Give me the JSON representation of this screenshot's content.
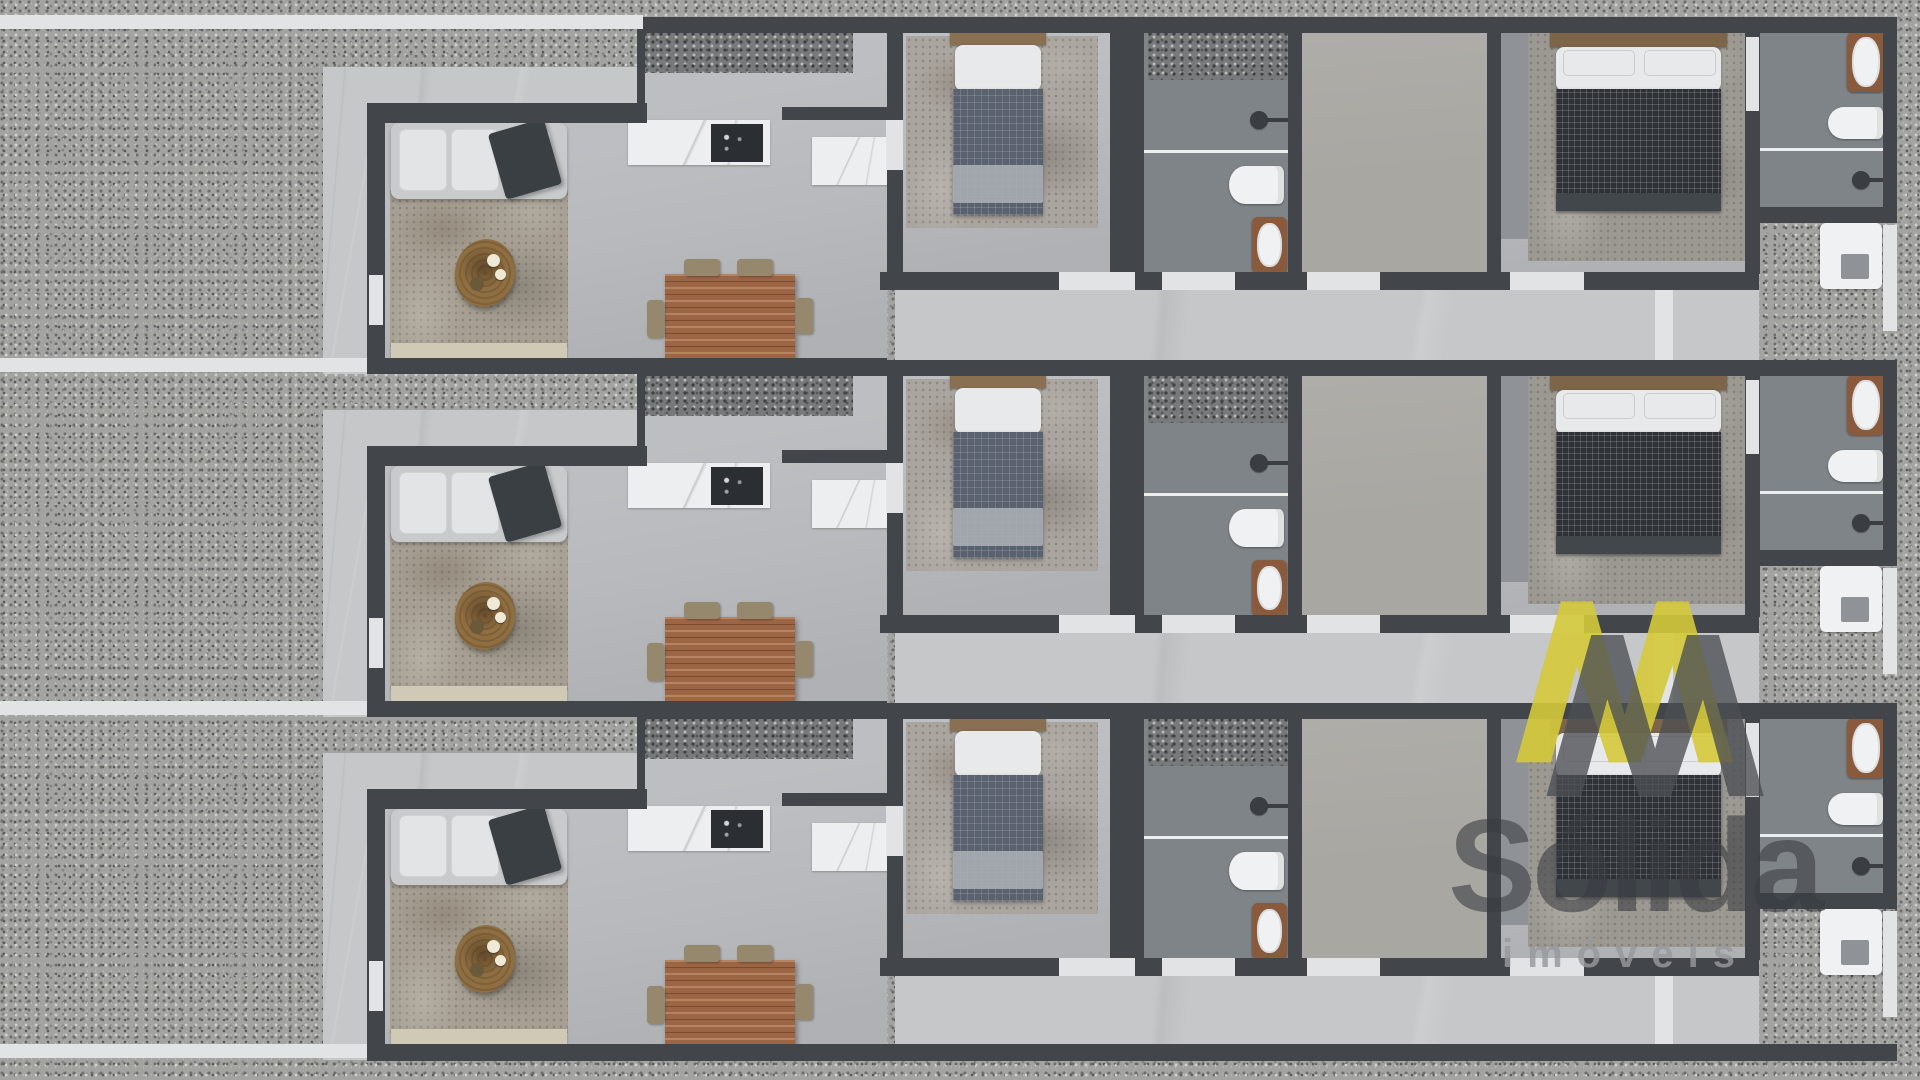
{
  "canvas": {
    "width": 1920,
    "height": 1080
  },
  "watermark": {
    "brand": "Sólida",
    "subtitle": "imóveis",
    "logo_icon": "double-mountain-M-monogram",
    "logo_yellow": "#d5c93a",
    "logo_gray": "#4b4e53",
    "brand_text_color": "rgba(56,59,64,0.58)",
    "subtitle_text_color": "rgba(150,152,156,0.82)"
  },
  "palette": {
    "wall": "#42464b",
    "floor": "#b8babd",
    "walkway": "#c5c7c8",
    "path": "#e2e3e4",
    "gravel": "#a3a3a1",
    "pebble": "#77797a",
    "bathFloor": "#7f8488",
    "hallFloor": "#a8a7a2",
    "cabinet": "#8f9397",
    "marble": "#edeeef",
    "cooktop": "#2b2f33",
    "rugBrown": "#a69f92",
    "rugGray": "#aaa59e",
    "rugGray2": "#9c9892",
    "sofa": "#c8cacc",
    "cushion": "#e3e4e5",
    "throw": "#3a3f44",
    "ctable": "#8f6e41",
    "plate": "#efe9d8",
    "plateDark": "#6b5a3a",
    "bench": "#cfc9b6",
    "dwood": "#9c6544",
    "chair": "#95886c",
    "woodHead": "#8a7052",
    "woodHead2": "#7c6549",
    "pillow": "#e8e9ea",
    "denim": "#5a6270",
    "tufted": "#2e3237",
    "blanket": "#a9aeb4",
    "footboard": "#42474c",
    "white": "#f0f1f2",
    "frame": "#8a5a3d",
    "shower": "#3a3e42"
  },
  "units": [
    {
      "id": "house-unit-1",
      "y": 17
    },
    {
      "id": "house-unit-2",
      "y": 360
    },
    {
      "id": "house-unit-3",
      "y": 703
    }
  ],
  "unit_template": [
    {
      "name": "front-path",
      "cls": "path",
      "x": 0,
      "y": -2,
      "w": 367,
      "h": 14
    },
    {
      "name": "front-walkway",
      "cls": "walkway",
      "x": 323,
      "y": 50,
      "w": 320,
      "h": 36
    },
    {
      "name": "side-walkway",
      "cls": "walkway",
      "x": 323,
      "y": 50,
      "w": 44,
      "h": 307
    },
    {
      "name": "back-terrace",
      "cls": "walkway",
      "x": 895,
      "y": 273,
      "w": 864,
      "h": 70
    },
    {
      "name": "terrace-step",
      "cls": "path",
      "x": 1655,
      "y": 273,
      "w": 18,
      "h": 70
    },
    {
      "name": "utility-pad",
      "cls": "pad",
      "x": 1820,
      "y": 206,
      "w": 62,
      "h": 66
    },
    {
      "name": "utility-pad-basin",
      "cls": "pad-inner",
      "x": 1841,
      "y": 237,
      "w": 28,
      "h": 25
    },
    {
      "name": "right-path",
      "cls": "path",
      "x": 1883,
      "y": 208,
      "w": 14,
      "h": 106
    },
    {
      "name": "kitchen-floor",
      "cls": "floor",
      "x": 637,
      "y": 14,
      "w": 250,
      "h": 329
    },
    {
      "name": "kitchen-garden-pebbles",
      "cls": "pebbles",
      "x": 643,
      "y": 15,
      "w": 210,
      "h": 41
    },
    {
      "name": "living-room-floor",
      "cls": "floor",
      "x": 383,
      "y": 103,
      "w": 504,
      "h": 240
    },
    {
      "name": "bedroom1-floor",
      "cls": "floor",
      "x": 901,
      "y": 14,
      "w": 211,
      "h": 243
    },
    {
      "name": "bathroom1-floor",
      "cls": "bath-floor",
      "x": 1142,
      "y": 14,
      "w": 148,
      "h": 243
    },
    {
      "name": "corridor-floor",
      "cls": "hall-floor",
      "x": 1300,
      "y": 14,
      "w": 189,
      "h": 243
    },
    {
      "name": "bedroom2-floor",
      "cls": "floor",
      "x": 1499,
      "y": 14,
      "w": 248,
      "h": 243
    },
    {
      "name": "bedroom2-closet",
      "cls": "cabinet",
      "x": 1499,
      "y": 16,
      "w": 30,
      "h": 206
    },
    {
      "name": "bathroom2-floor",
      "cls": "bath-floor",
      "x": 1758,
      "y": 14,
      "w": 127,
      "h": 178
    },
    {
      "name": "living-rug",
      "cls": "rug-brown",
      "x": 390,
      "y": 173,
      "w": 178,
      "h": 157
    },
    {
      "name": "sofa",
      "cls": "sofa",
      "x": 391,
      "y": 106,
      "w": 176,
      "h": 76
    },
    {
      "name": "sofa-cushion",
      "cls": "cushion",
      "x": 399,
      "y": 112,
      "w": 48,
      "h": 62
    },
    {
      "name": "sofa-cushion",
      "cls": "cushion",
      "x": 451,
      "y": 112,
      "w": 48,
      "h": 62
    },
    {
      "name": "sofa-cushion",
      "cls": "cushion",
      "x": 503,
      "y": 112,
      "w": 48,
      "h": 62
    },
    {
      "name": "sofa-throw-blanket",
      "cls": "throw",
      "x": 496,
      "y": 108,
      "w": 58,
      "h": 68,
      "r": -16
    },
    {
      "name": "coffee-table",
      "cls": "ctable",
      "x": 455,
      "y": 222,
      "w": 60,
      "h": 68,
      "r": 12
    },
    {
      "name": "coffee-table-plate",
      "cls": "plate",
      "x": 487,
      "y": 237,
      "w": 13,
      "h": 13
    },
    {
      "name": "coffee-table-plate",
      "cls": "plate",
      "x": 495,
      "y": 252,
      "w": 11,
      "h": 11
    },
    {
      "name": "coffee-table-bowl",
      "cls": "plate-dark",
      "x": 470,
      "y": 260,
      "w": 14,
      "h": 14
    },
    {
      "name": "window-bench",
      "cls": "bench",
      "x": 391,
      "y": 326,
      "w": 176,
      "h": 15
    },
    {
      "name": "kitchen-counter",
      "cls": "marble",
      "x": 628,
      "y": 103,
      "w": 142,
      "h": 45
    },
    {
      "name": "cooktop",
      "cls": "cooktop",
      "x": 711,
      "y": 107,
      "w": 52,
      "h": 38
    },
    {
      "name": "sink-counter",
      "cls": "marble",
      "x": 812,
      "y": 120,
      "w": 78,
      "h": 48
    },
    {
      "name": "dining-table",
      "cls": "dtable",
      "x": 665,
      "y": 257,
      "w": 130,
      "h": 86
    },
    {
      "name": "dining-chair",
      "cls": "chair",
      "x": 684,
      "y": 242,
      "w": 36,
      "h": 17
    },
    {
      "name": "dining-chair",
      "cls": "chair",
      "x": 737,
      "y": 242,
      "w": 36,
      "h": 17
    },
    {
      "name": "dining-chair",
      "cls": "chair-side",
      "x": 647,
      "y": 283,
      "w": 17,
      "h": 38
    },
    {
      "name": "dining-chair",
      "cls": "chair-side",
      "x": 796,
      "y": 281,
      "w": 17,
      "h": 36
    },
    {
      "name": "bedroom1-rug",
      "cls": "rug-gray",
      "x": 906,
      "y": 19,
      "w": 192,
      "h": 192
    },
    {
      "name": "bed1-headboard",
      "cls": "wood-head",
      "x": 950,
      "y": 14,
      "w": 96,
      "h": 14
    },
    {
      "name": "bed1-pillow",
      "cls": "pillow",
      "x": 955,
      "y": 28,
      "w": 86,
      "h": 46
    },
    {
      "name": "bed1-duvet",
      "cls": "duvet-denim",
      "x": 953,
      "y": 72,
      "w": 90,
      "h": 126
    },
    {
      "name": "bed1-foot-blanket",
      "cls": "blanket",
      "x": 953,
      "y": 148,
      "w": 90,
      "h": 38
    },
    {
      "name": "bathroom1-pebbles",
      "cls": "pebbles",
      "x": 1148,
      "y": 15,
      "w": 140,
      "h": 48
    },
    {
      "name": "shower1-glass",
      "cls": "glass",
      "x": 1144,
      "y": 133,
      "w": 144,
      "h": 3
    },
    {
      "name": "shower1-arm",
      "cls": "shower-arm",
      "x": 1266,
      "y": 101,
      "w": 22,
      "h": 4
    },
    {
      "name": "shower1-head",
      "cls": "shower",
      "x": 1250,
      "y": 94,
      "w": 18,
      "h": 18
    },
    {
      "name": "toilet1",
      "cls": "toilet",
      "x": 1229,
      "y": 149,
      "w": 55,
      "h": 38
    },
    {
      "name": "sink1-frame",
      "cls": "wood-frame",
      "x": 1252,
      "y": 200,
      "w": 35,
      "h": 56
    },
    {
      "name": "sink1-bowl",
      "cls": "bowl",
      "x": 1257,
      "y": 206,
      "w": 25,
      "h": 44
    },
    {
      "name": "bedroom2-rug",
      "cls": "rug-gray2",
      "x": 1528,
      "y": 14,
      "w": 222,
      "h": 230
    },
    {
      "name": "bed2-headboard",
      "cls": "wood-head2",
      "x": 1550,
      "y": 16,
      "w": 177,
      "h": 14
    },
    {
      "name": "bed2-linen",
      "cls": "pillow",
      "x": 1556,
      "y": 30,
      "w": 165,
      "h": 44
    },
    {
      "name": "bed2-pillow",
      "cls": "pillow2",
      "x": 1563,
      "y": 33,
      "w": 72,
      "h": 26
    },
    {
      "name": "bed2-pillow",
      "cls": "pillow2",
      "x": 1644,
      "y": 33,
      "w": 72,
      "h": 26
    },
    {
      "name": "bed2-duvet",
      "cls": "duvet-tufted",
      "x": 1556,
      "y": 72,
      "w": 165,
      "h": 106
    },
    {
      "name": "bed2-footboard",
      "cls": "footboard",
      "x": 1556,
      "y": 176,
      "w": 165,
      "h": 18
    },
    {
      "name": "bathtub-frame",
      "cls": "wood-frame",
      "x": 1847,
      "y": 15,
      "w": 38,
      "h": 60
    },
    {
      "name": "bathtub",
      "cls": "bowl",
      "x": 1852,
      "y": 20,
      "w": 28,
      "h": 50
    },
    {
      "name": "toilet2",
      "cls": "toilet",
      "x": 1828,
      "y": 90,
      "w": 55,
      "h": 32
    },
    {
      "name": "shower2-glass",
      "cls": "glass",
      "x": 1758,
      "y": 131,
      "w": 127,
      "h": 3
    },
    {
      "name": "shower2-arm",
      "cls": "shower-arm",
      "x": 1869,
      "y": 161,
      "w": 16,
      "h": 4
    },
    {
      "name": "shower2-head",
      "cls": "shower",
      "x": 1852,
      "y": 154,
      "w": 18,
      "h": 18
    },
    {
      "name": "kitchen-left-wall",
      "cls": "wall",
      "x": 637,
      "y": 0,
      "w": 8,
      "h": 103
    },
    {
      "name": "north-wall",
      "cls": "wall",
      "x": 637,
      "y": 0,
      "w": 1260,
      "h": 16
    },
    {
      "name": "living-top-wall",
      "cls": "wall",
      "x": 367,
      "y": 86,
      "w": 280,
      "h": 20
    },
    {
      "name": "kitchen-wall-segment",
      "cls": "wall",
      "x": 782,
      "y": 90,
      "w": 111,
      "h": 13
    },
    {
      "name": "living-left-wall",
      "cls": "wall",
      "x": 367,
      "y": 86,
      "w": 18,
      "h": 271
    },
    {
      "name": "living-bottom-wall",
      "cls": "wall",
      "x": 367,
      "y": 341,
      "w": 520,
      "h": 16
    },
    {
      "name": "kitchen-bedroom1-wall",
      "cls": "wall",
      "x": 887,
      "y": 16,
      "w": 16,
      "h": 241
    },
    {
      "name": "bedroom1-bathroom1-wall",
      "cls": "wall",
      "x": 1110,
      "y": 14,
      "w": 34,
      "h": 243
    },
    {
      "name": "bathroom1-corridor-wall",
      "cls": "wall",
      "x": 1288,
      "y": 14,
      "w": 14,
      "h": 243
    },
    {
      "name": "corridor-bedroom2-wall",
      "cls": "wall",
      "x": 1487,
      "y": 14,
      "w": 14,
      "h": 243
    },
    {
      "name": "bedroom2-bathroom2-wall",
      "cls": "wall",
      "x": 1745,
      "y": 14,
      "w": 15,
      "h": 243
    },
    {
      "name": "east-wall",
      "cls": "wall",
      "x": 1883,
      "y": 14,
      "w": 14,
      "h": 192
    },
    {
      "name": "bathroom2-bottom-wall",
      "cls": "wall",
      "x": 1745,
      "y": 190,
      "w": 152,
      "h": 16
    },
    {
      "name": "bedroom-wing-bottom-wall",
      "cls": "wall",
      "x": 880,
      "y": 255,
      "w": 879,
      "h": 18
    },
    {
      "name": "living-window",
      "cls": "opening",
      "x": 369,
      "y": 258,
      "w": 14,
      "h": 50
    },
    {
      "name": "kitchen-door",
      "cls": "opening",
      "x": 886,
      "y": 103,
      "w": 17,
      "h": 50
    },
    {
      "name": "bedroom2-door",
      "cls": "opening",
      "x": 1746,
      "y": 20,
      "w": 13,
      "h": 74
    },
    {
      "name": "door-threshold",
      "cls": "opening",
      "x": 1059,
      "y": 255,
      "w": 76,
      "h": 18
    },
    {
      "name": "door-threshold",
      "cls": "opening",
      "x": 1162,
      "y": 255,
      "w": 73,
      "h": 18
    },
    {
      "name": "door-threshold",
      "cls": "opening",
      "x": 1307,
      "y": 255,
      "w": 73,
      "h": 18
    },
    {
      "name": "door-threshold",
      "cls": "opening",
      "x": 1510,
      "y": 255,
      "w": 74,
      "h": 18
    }
  ],
  "globals_after": [
    {
      "name": "boundary-wall",
      "cls": "wall",
      "x": 367,
      "y": 1044,
      "w": 1530,
      "h": 17
    },
    {
      "name": "bottom-path",
      "cls": "path",
      "x": 0,
      "y": 1044,
      "w": 367,
      "h": 14
    },
    {
      "name": "top-path",
      "cls": "path",
      "x": 367,
      "y": 15,
      "w": 276,
      "h": 14
    }
  ]
}
